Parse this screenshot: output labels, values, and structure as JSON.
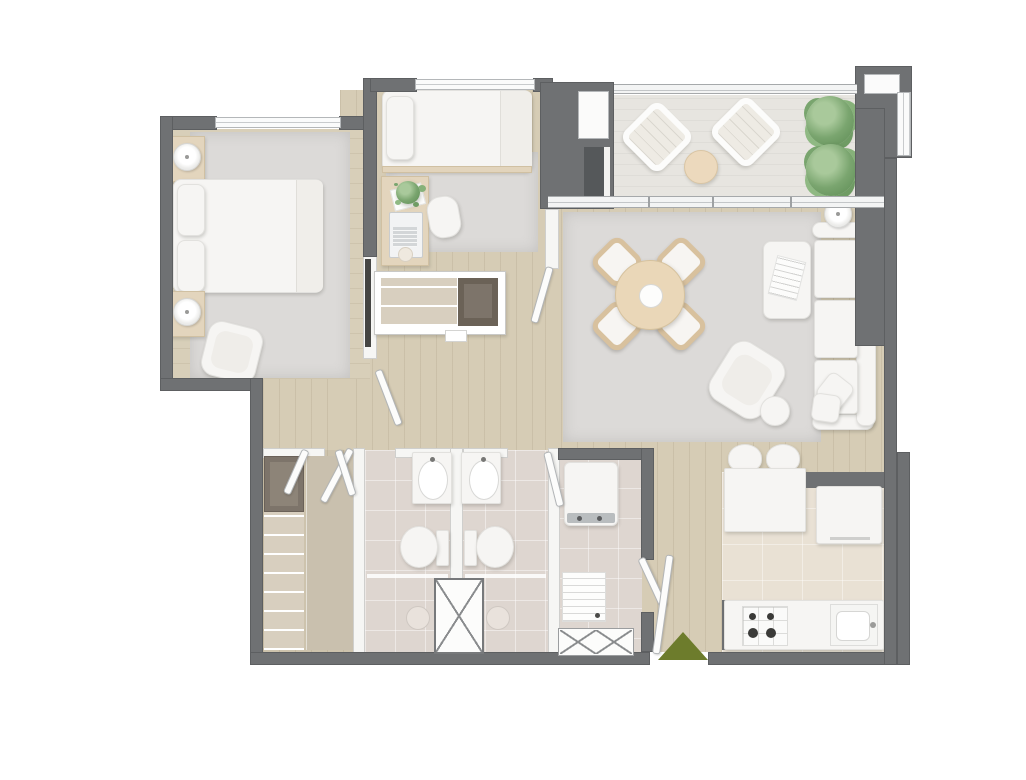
{
  "meta": {
    "kind": "architectural floor plan",
    "view": "top-down 3D rendered apartment plan",
    "visible_text": "none"
  },
  "palette": {
    "wall_gray": "#6f7173",
    "white_wall": "#f6f6f4",
    "wood_floor": "#d6ccb5",
    "terrace_floor": "#e7e5e0",
    "bathroom_tile": "#ded6d0",
    "kitchen_tile": "#e9e1d4",
    "rug_gray": "#dcdad8",
    "furniture_white": "#f6f5f3",
    "furniture_wood": "#e3d5bd",
    "plant_green": "#7aa56f",
    "entrance_green": "#6d7c2c"
  },
  "rooms": {
    "master_bedroom": {
      "name": "Master bedroom",
      "furniture": [
        "double bed with two pillows",
        "nightstand with lamp (top)",
        "nightstand with lamp (bottom)",
        "armchair",
        "area rug"
      ],
      "has_window": true
    },
    "bedroom_2": {
      "name": "Bedroom 2",
      "furniture": [
        "single bed with pillow",
        "desk",
        "laptop",
        "desk plant",
        "desk chair",
        "pencil cup",
        "wardrobe unit with shelves"
      ],
      "has_window": true
    },
    "hallway": {
      "name": "Hallway",
      "furniture": [
        "wall TV panel"
      ]
    },
    "terrace": {
      "name": "Terrace",
      "furniture": [
        "lounge chair (left)",
        "lounge chair (right)",
        "round coffee table",
        "plant (upper)",
        "plant (lower)"
      ],
      "features": [
        "sliding glass doors",
        "glass railing",
        "grill niche"
      ]
    },
    "living_dining": {
      "name": "Living / dining room",
      "furniture": [
        "round dining table with centerpiece",
        "4 dining chairs",
        "three-seat sofa",
        "2 sofa cushions",
        "floor lamp",
        "ottoman table with magazine",
        "armchair",
        "round side table",
        "area rug"
      ]
    },
    "kitchen": {
      "name": "Kitchen",
      "furniture": [
        "breakfast bar",
        "2 bar stools",
        "refrigerator",
        "kitchen counter",
        "4-burner cooktop",
        "sink"
      ]
    },
    "bathroom_1": {
      "name": "Bathroom 1",
      "furniture": [
        "vanity sink",
        "toilet",
        "shower drain"
      ]
    },
    "bathroom_2": {
      "name": "Bathroom 2",
      "furniture": [
        "vanity sink",
        "toilet",
        "shower drain"
      ]
    },
    "laundry": {
      "name": "Laundry room",
      "furniture": [
        "washing machine",
        "drain tray",
        "floor grate"
      ]
    },
    "closet": {
      "name": "Closet / storage",
      "furniture": [
        "cabinet",
        "shelving column",
        "wardrobe counter"
      ]
    },
    "entry": {
      "name": "Entry",
      "features": [
        "entry door",
        "entrance arrow marker"
      ]
    }
  },
  "core": {
    "elevator_shaft": {
      "name": "Shaft",
      "symbol": "X-crossed box"
    }
  },
  "markers": {
    "entrance_arrow": {
      "shape": "upward triangle",
      "color": "#6d7c2c"
    }
  }
}
